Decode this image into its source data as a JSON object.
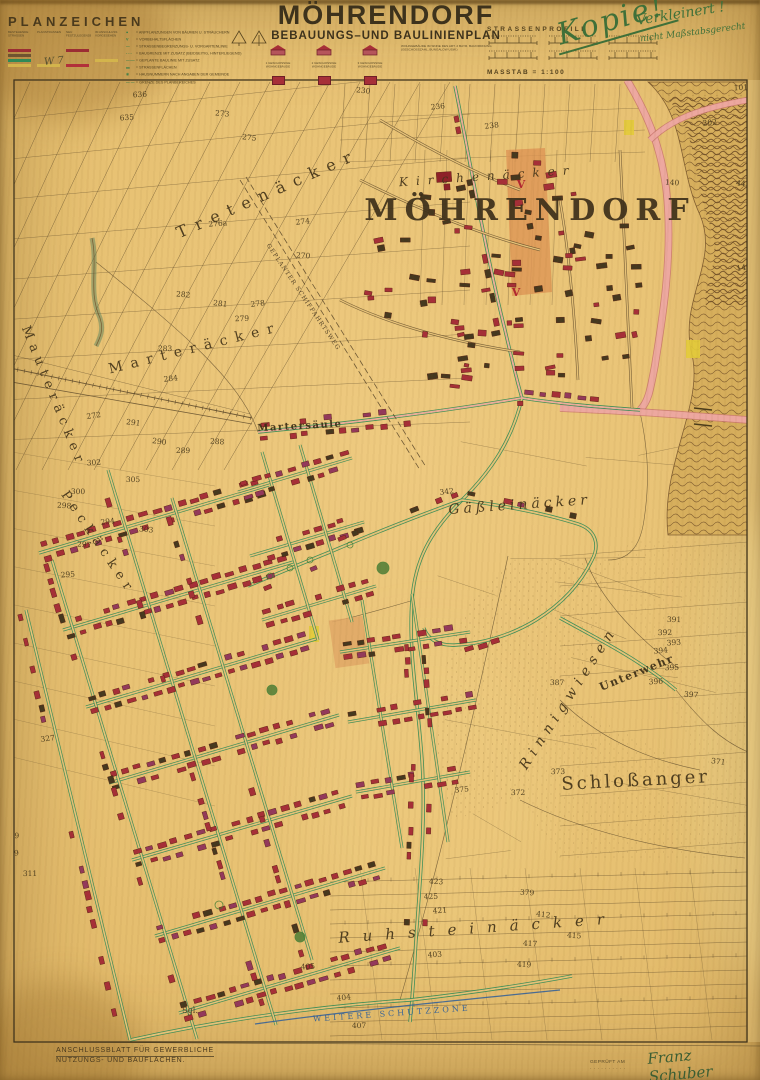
{
  "header": {
    "legend_title": "PLANZEICHEN",
    "legend_hand_mark": "W 7",
    "legend_columns": [
      {
        "label": "BESTEHENDE STRASSEN",
        "swatches": [
          {
            "color": "#9b2d33",
            "dashed": false
          },
          {
            "color": "#6f5430",
            "dashed": false
          },
          {
            "color": "#2f8a57",
            "dashed": false
          },
          {
            "color": "#d3b44c",
            "dashed": false
          }
        ]
      },
      {
        "label": "PLANSTRASSEN",
        "swatches": [
          {
            "color": "#9b2d33",
            "dashed": true
          },
          {
            "color": "#6f5430",
            "dashed": true
          },
          {
            "color": "#2f8a57",
            "dashed": true
          },
          {
            "color": "#d3b44c",
            "dashed": false
          }
        ]
      },
      {
        "label": "NEU FESTZULEGENDE",
        "swatches": [
          {
            "color": "#9b2d33",
            "dashed": false
          },
          {
            "color": "#55514a",
            "dashed": true
          },
          {
            "color": "#2f8a57",
            "dashed": true
          },
          {
            "color": "#b2303a",
            "dashed": false
          }
        ]
      },
      {
        "label": "IM ANSCHLUSS VORGESEHEN",
        "swatches": [
          {
            "color": "#8a8174",
            "dashed": true
          },
          {
            "color": "#8a8174",
            "dashed": true
          },
          {
            "color": "#d3b44c",
            "dashed": false
          }
        ]
      }
    ],
    "legend_lines": [
      {
        "sym": "●",
        "text": "= ANPFLANZUNGEN VON BÄUMEN U. STRÄUCHERN"
      },
      {
        "sym": "V",
        "text": "= VORBEHALTSFLÄCHEN"
      },
      {
        "sym": "—",
        "text": "= STRASSENBEGRENZUNGS- U. VORGARTENLINIE"
      },
      {
        "sym": "- - -",
        "text": "= BAUGRENZE MIT ZUSATZ (BEIDSEITIG, HINTERLIEGEND)"
      },
      {
        "sym": "—·—",
        "text": "= GEPLANTE BAULINIE MIT ZUSATZ"
      },
      {
        "sym": "▬",
        "text": "= STRASSENFLÄCHEN"
      },
      {
        "sym": "⑥",
        "text": "= HAUSNUMMERN NACH ANGABEN DER GEMEINDE"
      },
      {
        "sym": "— —",
        "text": "= GRENZE DES PLANBEREICHES"
      }
    ],
    "title": "MÖHRENDORF",
    "subtitle": "BEBAUUNGS–UND BAULINIENPLAN",
    "building_symbols": [
      {
        "caption": "1 GESCHOSSIGE WOHNGEBÄUDE"
      },
      {
        "caption": "2 GESCHOSSIGE WOHNGEBÄUDE"
      },
      {
        "caption": "3 GESCHOSSIGE WOHNGEBÄUDE"
      }
    ],
    "building_note": "WOHNGEBÄUDE IM SINNE DES ART. 2 BAYR. BAUORDNUNG (GESCHOSSZAHL, BUNGALOW USW.)",
    "profiles_title": "STRASSENPROFILE",
    "scale_label": "MASSTAB = 1:100",
    "hand_notes": {
      "kopie": "Kopie!",
      "verkleinert": "Verkleinert !",
      "massstab": "nicht Maßstabsgerecht"
    }
  },
  "map": {
    "accent_colors": {
      "paper": "#e7c379",
      "ink": "#5a4729",
      "building_red": "#a62f38",
      "building_crimson": "#93395c",
      "building_dark": "#45381f",
      "street_green": "#2e8a57",
      "road_pink": "#eeaaa2",
      "zone_orange": "#dd9555",
      "zone_yellow": "#e3cb3a",
      "schutzzone_blue": "#2d5e9b",
      "handwriting_green": "#3f7039"
    },
    "place_labels": [
      {
        "t": "MÖHRENDORF",
        "x": 530,
        "y": 220,
        "s": 30,
        "r": 0,
        "ls": 7,
        "c": "ink-big"
      },
      {
        "t": "Kirchenäcker",
        "x": 488,
        "y": 180,
        "s": 12,
        "r": -4,
        "ls": 8,
        "c": "serif-it"
      },
      {
        "t": "Tretenäcker",
        "x": 270,
        "y": 198,
        "s": 16,
        "r": -24,
        "ls": 9,
        "c": "serif"
      },
      {
        "t": "Mauteräcker",
        "x": 50,
        "y": 398,
        "s": 13,
        "r": 68,
        "ls": 6,
        "c": "serif"
      },
      {
        "t": "Marteräcker",
        "x": 196,
        "y": 352,
        "s": 14,
        "r": -14,
        "ls": 8,
        "c": "serif"
      },
      {
        "t": "Peckäcker",
        "x": 95,
        "y": 545,
        "s": 13,
        "r": 56,
        "ls": 6,
        "c": "serif"
      },
      {
        "t": "Martersäule",
        "x": 300,
        "y": 429,
        "s": 10,
        "r": -3,
        "ls": 1.5,
        "c": "serif-b"
      },
      {
        "t": "Gäßleinäcker",
        "x": 520,
        "y": 509,
        "s": 14,
        "r": -4,
        "ls": 4,
        "c": "serif-it"
      },
      {
        "t": "Rinnigwiesen",
        "x": 572,
        "y": 700,
        "s": 14,
        "r": -57,
        "ls": 6,
        "c": "serif-it"
      },
      {
        "t": "Unterwehr",
        "x": 638,
        "y": 676,
        "s": 11,
        "r": -22,
        "ls": 1.5,
        "c": "serif-b"
      },
      {
        "t": "Schloßanger",
        "x": 636,
        "y": 786,
        "s": 18,
        "r": -3,
        "ls": 3,
        "c": "serif"
      },
      {
        "t": "Ruhsteinäcker",
        "x": 478,
        "y": 933,
        "s": 15,
        "r": -4,
        "ls": 13,
        "c": "serif-it"
      },
      {
        "t": "WEITERE SCHUTZZONE",
        "x": 392,
        "y": 1016,
        "s": 8,
        "r": -4,
        "ls": 3,
        "c": "blue"
      },
      {
        "t": "GEPLANTER SCHIFFAHRTSWEG",
        "x": 302,
        "y": 298,
        "s": 6,
        "r": 56,
        "ls": 1,
        "c": "ink-small"
      },
      {
        "t": "Sgl.",
        "x": 190,
        "y": 1013,
        "s": 8,
        "r": 0,
        "ls": 0,
        "c": "ink-small"
      }
    ],
    "red_marks": [
      {
        "t": "V",
        "x": 521,
        "y": 188
      },
      {
        "t": "V",
        "x": 516,
        "y": 296
      }
    ],
    "parcel_numbers": [
      [
        "636",
        140,
        97
      ],
      [
        "635",
        127,
        120
      ],
      [
        "273",
        222,
        116
      ],
      [
        "275",
        249,
        140
      ],
      [
        "276a",
        218,
        226
      ],
      [
        "274",
        303,
        224
      ],
      [
        "270",
        303,
        258
      ],
      [
        "282",
        183,
        297
      ],
      [
        "281",
        220,
        306
      ],
      [
        "278",
        258,
        306
      ],
      [
        "279",
        242,
        321
      ],
      [
        "283",
        165,
        351
      ],
      [
        "284",
        171,
        381
      ],
      [
        "272",
        94,
        418
      ],
      [
        "291",
        133,
        425
      ],
      [
        "290",
        159,
        444
      ],
      [
        "289",
        183,
        453
      ],
      [
        "288",
        217,
        444
      ],
      [
        "302",
        94,
        465
      ],
      [
        "305",
        133,
        482
      ],
      [
        "300",
        78,
        494
      ],
      [
        "298",
        64,
        508
      ],
      [
        "294",
        108,
        524
      ],
      [
        "303",
        146,
        532
      ],
      [
        "297",
        84,
        547
      ],
      [
        "295",
        68,
        577
      ],
      [
        "230",
        363,
        93
      ],
      [
        "236",
        438,
        109
      ],
      [
        "238",
        492,
        128
      ],
      [
        "203",
        712,
        77
      ],
      [
        "101",
        741,
        90
      ],
      [
        "202",
        710,
        125
      ],
      [
        "140",
        672,
        185
      ],
      [
        "442",
        743,
        186
      ],
      [
        "147",
        744,
        270
      ],
      [
        "342",
        447,
        494
      ],
      [
        "387",
        557,
        685
      ],
      [
        "391",
        674,
        622
      ],
      [
        "392",
        665,
        635
      ],
      [
        "393",
        674,
        645
      ],
      [
        "394",
        661,
        653
      ],
      [
        "395",
        672,
        670
      ],
      [
        "396",
        656,
        684
      ],
      [
        "397",
        691,
        697
      ],
      [
        "371",
        718,
        764
      ],
      [
        "373",
        558,
        774
      ],
      [
        "372",
        518,
        795
      ],
      [
        "375",
        462,
        792
      ],
      [
        "379",
        527,
        895
      ],
      [
        "412",
        543,
        917
      ],
      [
        "415",
        574,
        938
      ],
      [
        "417",
        530,
        946
      ],
      [
        "423",
        436,
        884
      ],
      [
        "425",
        431,
        899
      ],
      [
        "421",
        440,
        913
      ],
      [
        "419",
        524,
        967
      ],
      [
        "403",
        435,
        957
      ],
      [
        "405",
        308,
        969
      ],
      [
        "404",
        344,
        1000
      ],
      [
        "407",
        359,
        1028
      ],
      [
        "327",
        48,
        741
      ],
      [
        "309",
        12,
        856
      ],
      [
        "311",
        30,
        876
      ],
      [
        "329",
        12,
        838
      ]
    ],
    "footer_note_line1": "ANSCHLUSSBLATT FÜR GEWERBLICHE",
    "footer_note_line2": "NUTZUNGS- UND BAUFLÄCHEN.",
    "stamp_line1": "GEPRÜFT AM",
    "stamp_line2": "· · · · · · · · · ·",
    "signature": "Franz Schuber"
  }
}
